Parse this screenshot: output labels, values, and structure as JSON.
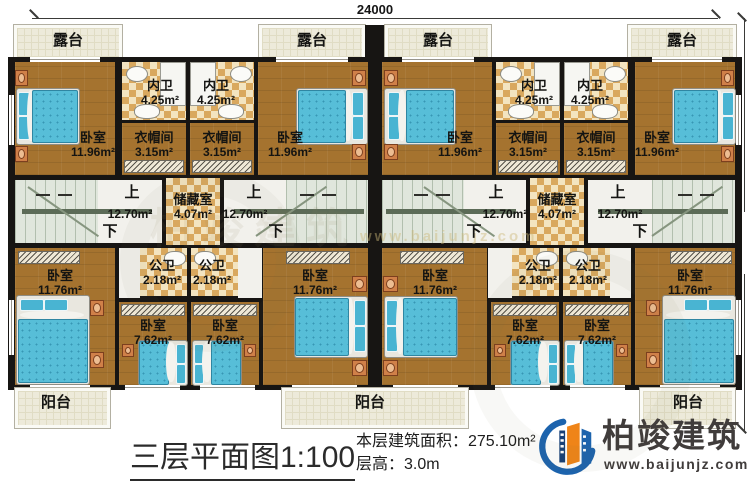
{
  "dimensions": {
    "top": "24000",
    "right": "13320"
  },
  "labels": {
    "terrace": "露台",
    "balcony": "阳台",
    "bedroom": "卧室",
    "inner_bath": "内卫",
    "cloakroom": "衣帽间",
    "storage": "储藏室",
    "public_bath": "公卫",
    "stair_up": "上",
    "stair_down": "下"
  },
  "areas": {
    "bedroom_top": "11.96m²",
    "inner_bath": "4.25m²",
    "cloakroom": "3.15m²",
    "stair_hall": "12.70m²",
    "storage": "4.07m²",
    "bedroom_bottom": "11.76m²",
    "bedroom_small": "7.62m²",
    "public_bath": "2.18m²"
  },
  "title_block": {
    "title": "三层平面图1:100",
    "floor_area_label": "本层建筑面积：275.10m²",
    "floor_height_label": "层高：3.0m"
  },
  "branding": {
    "company": "柏竣建筑",
    "website": "www.baijunjz.com",
    "logo_blue": "#1c63ad",
    "logo_orange": "#ef8418"
  }
}
